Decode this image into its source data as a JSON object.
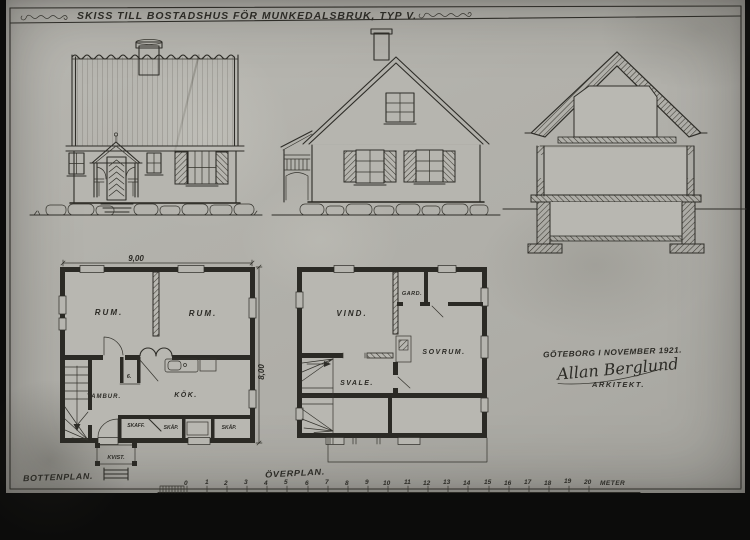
{
  "title": "SKISS TILL BOSTADSHUS FÖR MUNKEDALSBRUK, TYP V.",
  "plans": {
    "bottenplan": {
      "label": "BOTTENPLAN.",
      "width_dim": "9,00",
      "height_dim": "8,00",
      "rooms": {
        "rum_left": "RUM.",
        "rum_right": "RUM.",
        "tambur": "TAMBUR.",
        "kok": "KÖK.",
        "closet_no": "6.",
        "skaff": "SKAFF.",
        "skap1": "SKÅP.",
        "skap2": "SKÅP.",
        "kvist": "KVIST."
      }
    },
    "overplan": {
      "label": "ÖVERPLAN.",
      "rooms": {
        "vind": "VIND.",
        "gard": "GARD.",
        "sovrum": "SOVRUM.",
        "svale": "SVALE."
      }
    }
  },
  "signature": {
    "place_date": "GÖTEBORG I NOVEMBER 1921.",
    "name": "Allan Berglund",
    "role": "ARKITEKT."
  },
  "scale_bar": {
    "ticks": [
      "0",
      "1",
      "2",
      "3",
      "4",
      "5",
      "6",
      "7",
      "8",
      "9",
      "10",
      "11",
      "12",
      "13",
      "14",
      "15",
      "16",
      "17",
      "18",
      "19",
      "20"
    ],
    "unit": "METER"
  },
  "colors": {
    "paper": "#b2b1ab",
    "ink": "#2e2d28"
  }
}
